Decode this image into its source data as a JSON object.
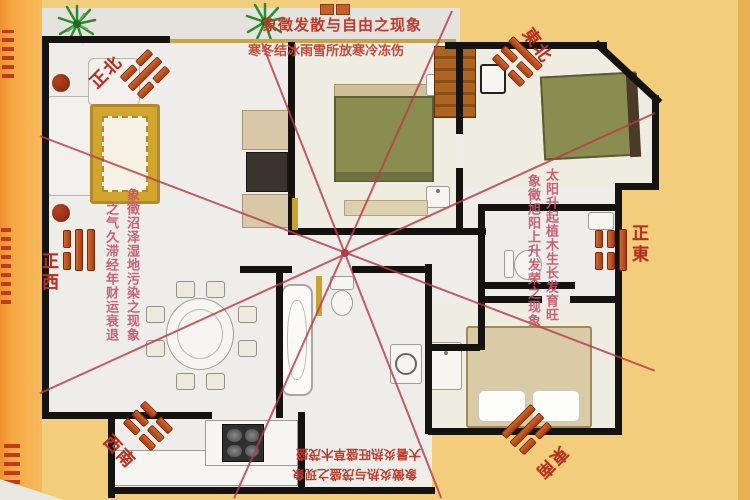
{
  "compass": {
    "north": {
      "label": "正北",
      "trigram_name": "坎",
      "bars": [
        "broken",
        "solid",
        "broken"
      ]
    },
    "northeast": {
      "label": "東北",
      "trigram_name": "艮",
      "bars": [
        "solid",
        "broken",
        "broken"
      ]
    },
    "east": {
      "label": "正東",
      "trigram_name": "震",
      "bars": [
        "broken",
        "broken",
        "solid"
      ]
    },
    "southeast": {
      "label": "東南",
      "trigram_name": "巽",
      "bars": [
        "solid",
        "solid",
        "broken"
      ]
    },
    "southwest": {
      "label": "西南",
      "trigram_name": "坤",
      "bars": [
        "broken",
        "broken",
        "broken"
      ]
    },
    "west": {
      "label": "正西",
      "trigram_name": "兌",
      "bars": [
        "broken",
        "solid",
        "solid"
      ]
    }
  },
  "annotations": {
    "north_line1": "象徵发散与自由之现象",
    "north_line2": "寒冬结冰雨雪所放寒冷冻伤",
    "west_col_inner": "象徵沼泽湿地污染之现象",
    "west_col_outer": "之气久滞经年财运衰退",
    "east_col_inner": "象徵旭阳上升发荣之现象",
    "east_col_outer": "太阳升起植木生长发育旺",
    "south_line1": "大暑炎热旺盛草木茂盛",
    "south_line2": "象徵炎热与茂盛之现象"
  },
  "colors": {
    "background": "#f2cd7c",
    "left_margin_orange": "#f5a843",
    "floor": "#eeedea",
    "wall": "#151310",
    "annotation_red": "#c03a2b",
    "annotation_pink": "#c6566a",
    "sha_line_red": "#b93a48",
    "trigram_bar_orange": "#b84a1a",
    "bed_green": "#8a8d50",
    "wardrobe_brown": "#ad6420",
    "rug_gold": "#d1a62e",
    "plant_green": "#2e8b2e"
  },
  "icons": {
    "plant": "green-starburst",
    "trigram_fragment": "two-orange-tiles",
    "sofa": "l-shaped-sofa",
    "rug": "ornate-gold-rug",
    "bed": "double-bed",
    "wardrobe": "striped-closet",
    "dining_table": "oval-table-with-chairs",
    "stove": "four-burner-cooktop",
    "toilet": "toilet-bowl",
    "bathtub": "oval-tub",
    "washer": "front-load-washer"
  }
}
